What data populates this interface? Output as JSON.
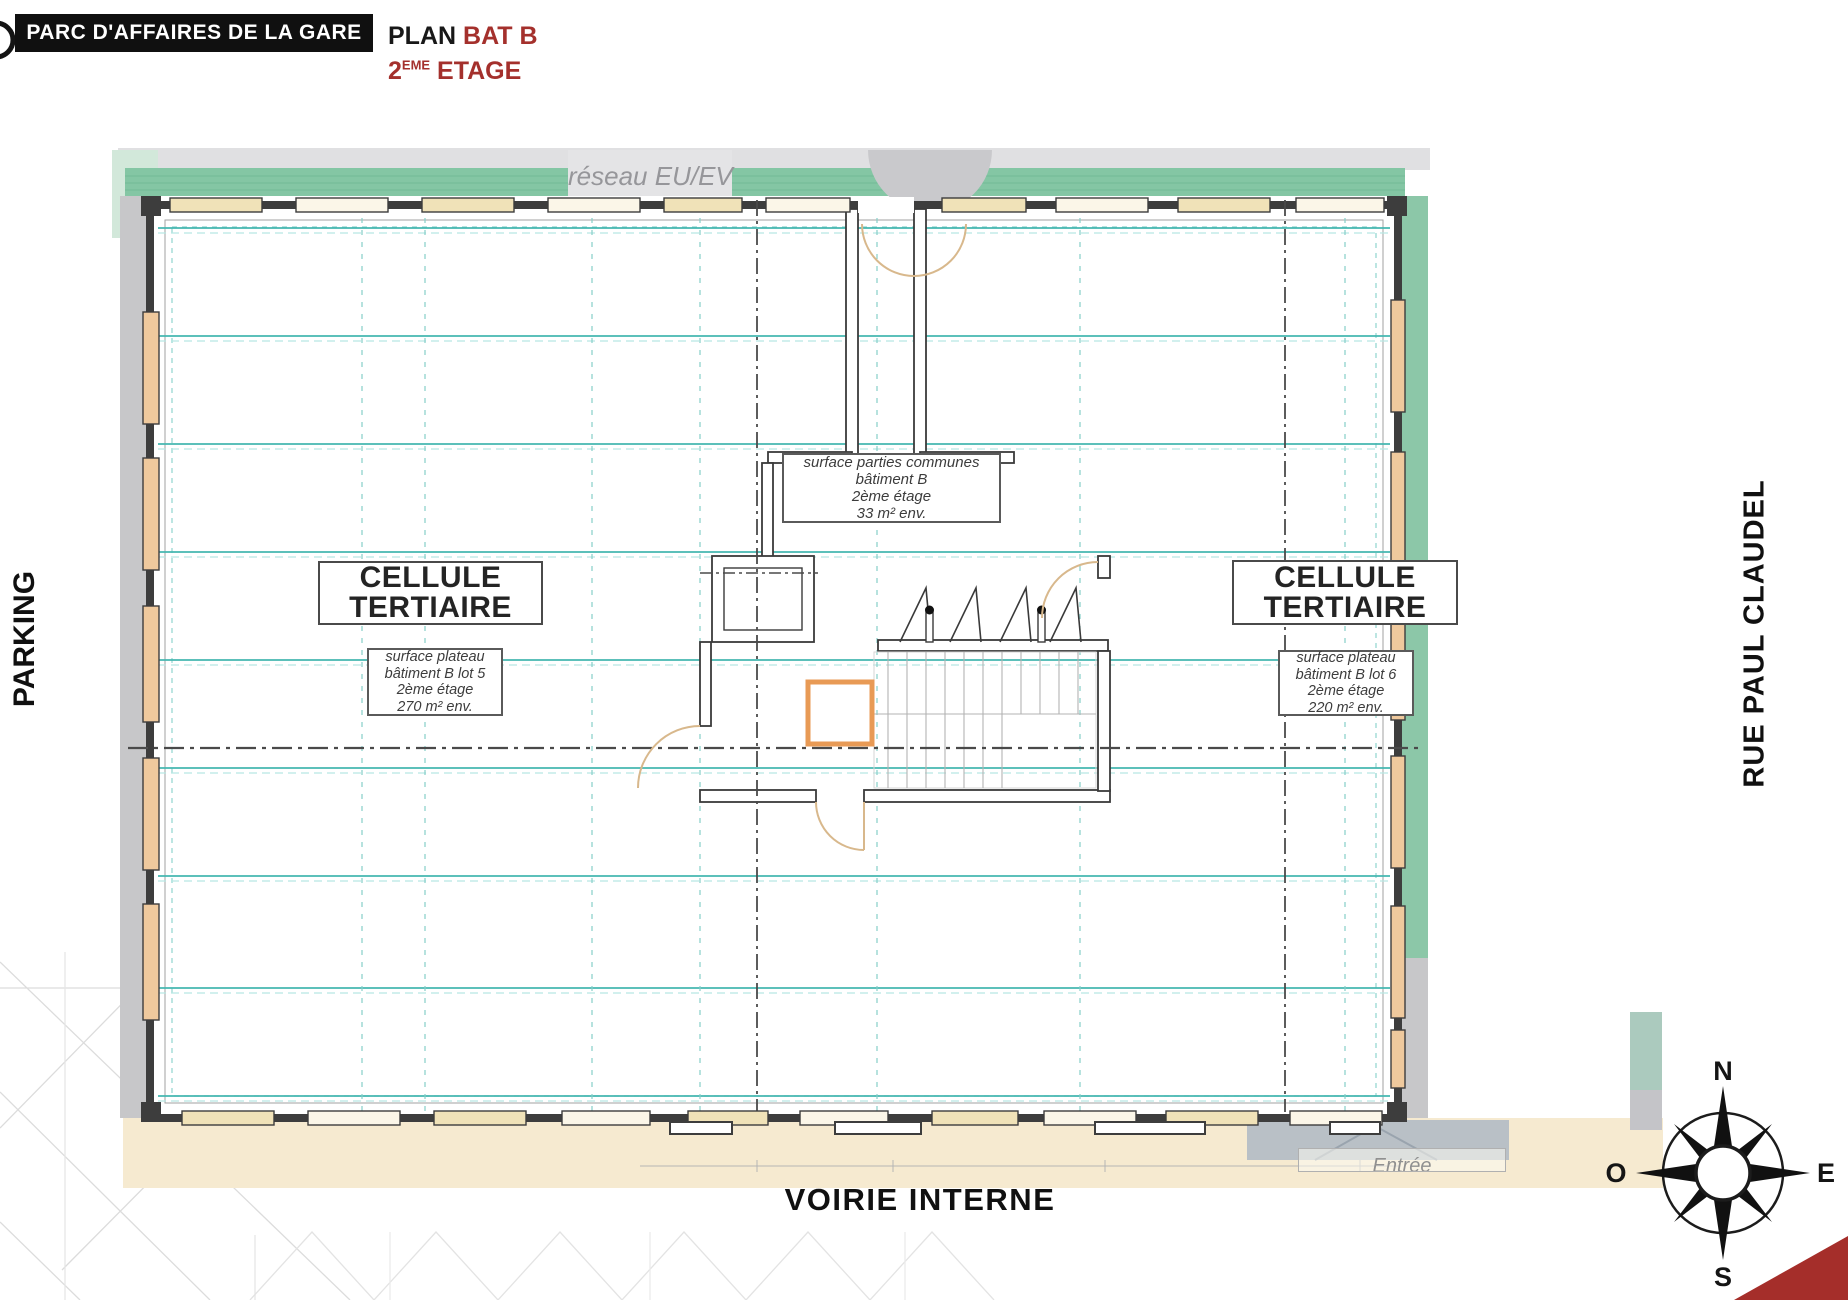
{
  "header": {
    "title": "PARC D'AFFAIRES DE LA GARE",
    "plan_word": "PLAN",
    "plan_building": "BAT B",
    "floor_number": "2",
    "floor_ordinal": "EME",
    "floor_word": "ETAGE"
  },
  "colors": {
    "accent_red": "#a4302c",
    "band_green": "#84c6a4",
    "line_teal": "#45b7b1",
    "wall_dark": "#3d3d3d",
    "shaft_orange": "#e89a55",
    "surface_beige": "#f6ead0"
  },
  "plan": {
    "network_label": "réseau EU/EV",
    "common_note": {
      "lines": [
        "surface parties communes",
        "bâtiment B",
        "2ème étage",
        "33 m² env."
      ]
    },
    "cell_left": {
      "line1": "CELLULE",
      "line2": "TERTIAIRE",
      "note": [
        "surface plateau",
        "bâtiment B lot 5",
        "2ème étage",
        "270 m² env."
      ]
    },
    "cell_right": {
      "line1": "CELLULE",
      "line2": "TERTIAIRE",
      "note": [
        "surface plateau",
        "bâtiment B lot 6",
        "2ème étage",
        "220 m² env."
      ]
    },
    "street_left": "PARKING",
    "street_right": "RUE PAUL CLAUDEL",
    "street_bottom": "VOIRIE INTERNE",
    "entrance_label": "Entrée",
    "compass": {
      "north": "N",
      "east": "E",
      "south": "S",
      "west": "O"
    }
  }
}
